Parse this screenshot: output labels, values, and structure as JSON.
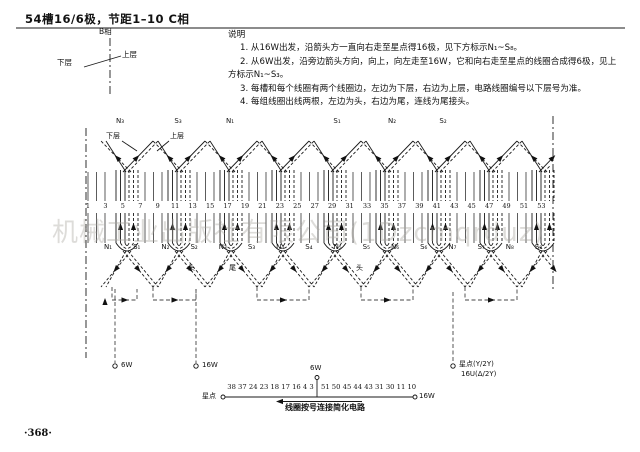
{
  "page": {
    "title": "54槽16/6极，节距1–10 C相",
    "page_number": "·368·",
    "watermark": "机械工业出版社有限公司(1Dzcmqrduz)"
  },
  "legend": {
    "phase": "B相",
    "lower": "下层",
    "upper": "上层"
  },
  "notes": {
    "lines": [
      {
        "text": "说明",
        "indent": 0
      },
      {
        "text": "1. 从16W出发，沿箭头方一直向右走至星点得16极，见下方标示N₁~S₈。",
        "indent": 1
      },
      {
        "text": "2. 从6W出发，沿旁边箭头方向，向上，向左走至16W，它和向右走至星点的线圈合成得6极，见上",
        "indent": 1
      },
      {
        "text": "方标示N₁~S₃。",
        "indent": 0
      },
      {
        "text": "3. 每槽和每个线圈有两个线圈边，左边为下层，右边为上层，电路线圈编号以下层号为准。",
        "indent": 1
      },
      {
        "text": "4. 每组线圈出线两根，左边为头，右边为尾，连线为尾接头。",
        "indent": 1
      }
    ]
  },
  "diagram": {
    "layer_labels": {
      "lower": "下层",
      "upper": "上层"
    },
    "top_pole_labels": [
      {
        "text": "N₃",
        "x": 120
      },
      {
        "text": "S₃",
        "x": 178
      },
      {
        "text": "N₁",
        "x": 230
      },
      {
        "text": "S₁",
        "x": 337
      },
      {
        "text": "N₂",
        "x": 392
      },
      {
        "text": "S₂",
        "x": 443
      }
    ],
    "bottom_pole_labels": {
      "start_x": 108,
      "step": 28.7,
      "labels": [
        "N₁",
        "S₁",
        "N₂",
        "S₂",
        "N₃",
        "S₃",
        "N₄",
        "S₄",
        "N₅",
        "S₅",
        "N₆",
        "S₆",
        "N₇",
        "S₇",
        "N₈",
        "S₈"
      ]
    },
    "slot_numbers": [
      1,
      3,
      5,
      7,
      9,
      11,
      13,
      15,
      17,
      19,
      21,
      23,
      25,
      27,
      29,
      31,
      33,
      35,
      37,
      39,
      41,
      43,
      45,
      47,
      49,
      51,
      53
    ],
    "head_tail_labels": [
      {
        "text": "头",
        "x": 192
      },
      {
        "text": "尾",
        "x": 233
      },
      {
        "text": "头",
        "x": 360
      }
    ],
    "terminals": [
      {
        "label": "6W",
        "x": 121
      },
      {
        "label": "16W",
        "x": 202
      }
    ],
    "star_terminal": {
      "line1": "星点(Y/2Y)",
      "line2": "16U(Δ/2Y)"
    }
  },
  "circuit": {
    "left_terminal": "星点",
    "numbers_left": "38 37 24 23 18 17 16 4 3",
    "numbers_right": "51 50 45 44 43 31 30 11 10",
    "tap": "6W",
    "right_terminal": "16W",
    "caption": "线圈按号连接简化电路"
  }
}
